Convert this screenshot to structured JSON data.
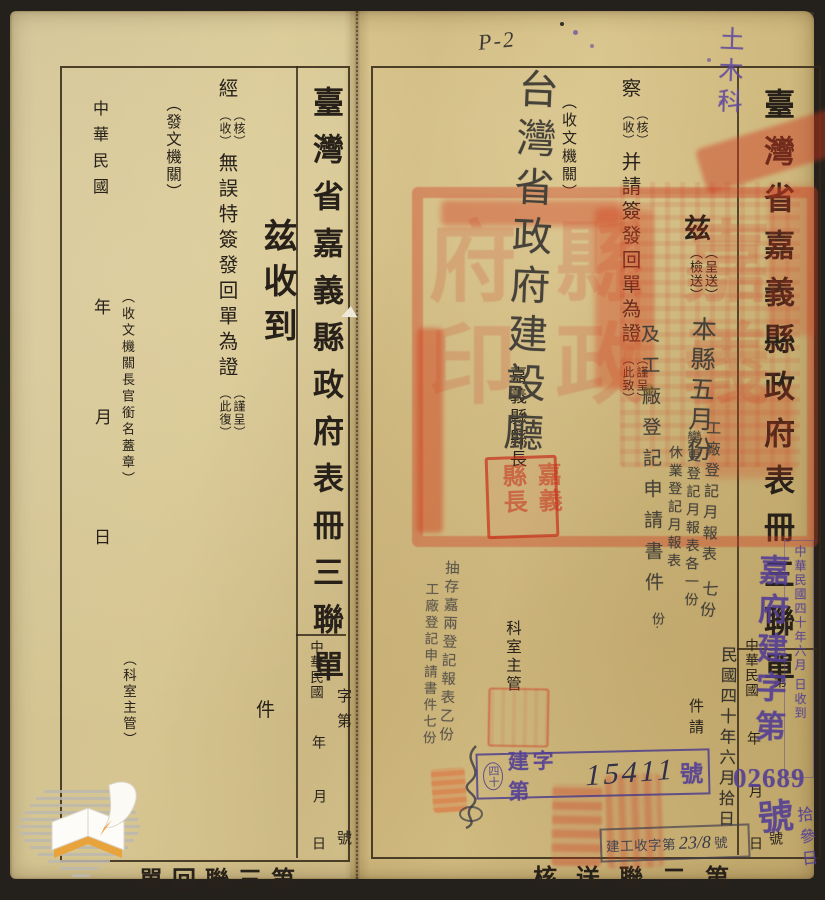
{
  "scan": {
    "page_annotation": "P-2",
    "department_note": "土木科"
  },
  "left_panel": {
    "title": "臺灣省嘉義縣政府表冊三聯單",
    "serial_prefix": "字第",
    "serial_suffix": "號",
    "era": "中華民國",
    "year": "年",
    "month": "月",
    "day": "日",
    "received_heading": "兹收到",
    "clause": {
      "lead": "經",
      "opt1": "（核）",
      "opt2": "（收）",
      "body": "無誤特簽發回單為證",
      "opt3": "（謹呈）",
      "opt4": "（此復）"
    },
    "issuing_org_label": "（發文機關）",
    "receiver_signature_label": "（收文機關長官銜名蓋章）",
    "section_chief_label": "（科室主管）",
    "count_unit": "件",
    "footer_label": "第三聯回單"
  },
  "right_panel": {
    "title": "臺灣省嘉義縣政府表冊三聯單",
    "serial_prefix": "字第",
    "serial_suffix": "號",
    "era": "中華民國",
    "year": "年",
    "month": "月",
    "day": "日",
    "clause1": {
      "lead": "兹",
      "opt1": "（呈送）",
      "opt2": "（檢送）",
      "tail": "件請"
    },
    "clause2": {
      "lead": "察",
      "opt1": "（核）",
      "opt2": "（收）",
      "body": "并請簽發回單為證",
      "opt3": "（謹呈）",
      "opt4": "（此致）"
    },
    "receiving_org_label": "（收文機關）",
    "magistrate_label": "嘉義縣縣長",
    "section_chief_label": "科室主管",
    "footer_label": "第二聯送核"
  },
  "handwriting": {
    "recipient": "台灣省政府建設廳",
    "content_lead": "本縣五月份",
    "content_items": [
      "工廠登記月報表",
      "變更登記月報表各一份",
      "休業登記月報表"
    ],
    "content_extra": "份·",
    "content_tail": "及工廠登記申請書件",
    "content_count": "七份",
    "dispatch_date": "民國四十年六月拾日",
    "margin_note_line1": "抽存嘉兩登記報表乙份",
    "margin_note_line2": "工廠登記申請書件七份",
    "received_day": "拾參日",
    "dispatch_number": "15411",
    "receipt_number": "23/8"
  },
  "stamps": {
    "registry_prefix": "嘉府建字第",
    "registry_number": "02689",
    "registry_suffix": "號",
    "dispatch_box": {
      "circled": "四十",
      "prefix": "建字第",
      "suffix": "號"
    },
    "receipt_box": {
      "prefix": "建工收字第",
      "suffix": "號"
    },
    "received_box_text": "中華民國四十年六月 日收到",
    "official_seal_text": "嘉義縣政府印",
    "magistrate_seal_text": "嘉義縣長"
  }
}
